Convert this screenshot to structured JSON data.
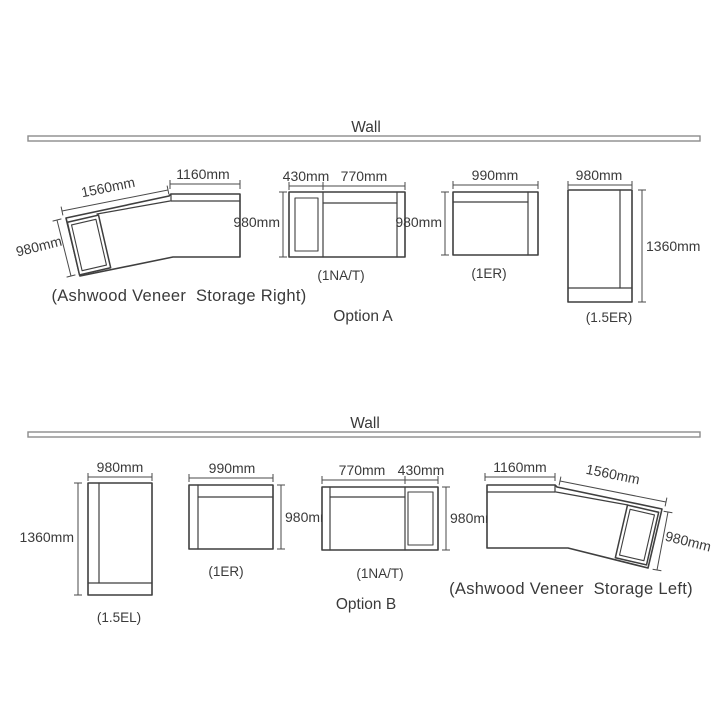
{
  "colors": {
    "line": "#3f3f3f",
    "wall": "#8c8c8c",
    "text": "#3a3a3a"
  },
  "optionA": {
    "wall_label": "Wall",
    "option_label": "Option A",
    "desk": {
      "caption": "(Ashwood Veneer  Storage Right)",
      "dim_top": "1160mm",
      "dim_angled": "1560mm",
      "dim_end": "980mm"
    },
    "nat": {
      "caption": "(1NA/T)",
      "dim_left": "430mm",
      "dim_right": "770mm",
      "dim_side": "980mm"
    },
    "er": {
      "caption": "(1ER)",
      "dim_top": "990mm",
      "dim_side": "980mm"
    },
    "er15": {
      "caption": "(1.5ER)",
      "dim_top": "980mm",
      "dim_side": "1360mm"
    }
  },
  "optionB": {
    "wall_label": "Wall",
    "option_label": "Option B",
    "el15": {
      "caption": "(1.5EL)",
      "dim_top": "980mm",
      "dim_side": "1360mm"
    },
    "er": {
      "caption": "(1ER)",
      "dim_top": "990mm",
      "dim_side": "980mm"
    },
    "nat": {
      "caption": "(1NA/T)",
      "dim_left": "770mm",
      "dim_right": "430mm",
      "dim_side": "980mm"
    },
    "desk": {
      "caption": "(Ashwood Veneer  Storage Left)",
      "dim_top": "1160mm",
      "dim_angled": "1560mm",
      "dim_end": "980mm"
    }
  }
}
